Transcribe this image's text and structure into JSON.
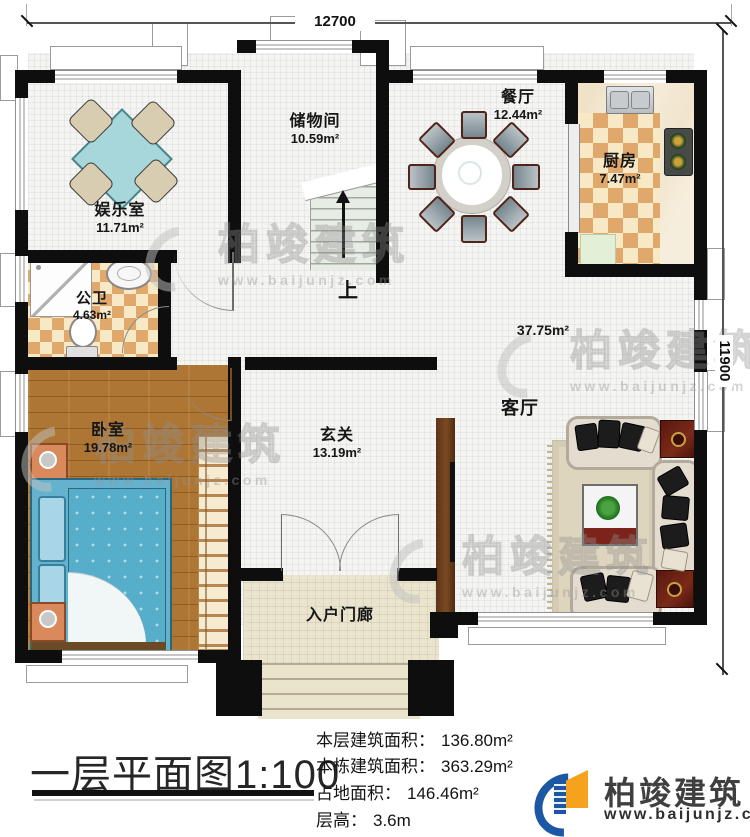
{
  "plan": {
    "title": "一层平面图1:100",
    "dim_top": "12700",
    "dim_right": "11900",
    "stairs_up": "上",
    "rooms": {
      "entertainment": {
        "name": "娱乐室",
        "area": "11.71m²"
      },
      "storage": {
        "name": "储物间",
        "area": "10.59m²"
      },
      "dining": {
        "name": "餐厅",
        "area": "12.44m²"
      },
      "kitchen": {
        "name": "厨房",
        "area": "7.47m²"
      },
      "bathroom": {
        "name": "公卫",
        "area": "4.63m²"
      },
      "bedroom": {
        "name": "卧室",
        "area": "19.78m²"
      },
      "foyer": {
        "name": "玄关",
        "area": "13.19m²"
      },
      "living": {
        "name": "客厅",
        "area": "37.75m²"
      },
      "porch": {
        "name": "入户门廊"
      }
    }
  },
  "info": {
    "floor_area": {
      "label": "本层建筑面积：",
      "value": "136.80m²"
    },
    "building_area": {
      "label": "本栋建筑面积：",
      "value": "363.29m²"
    },
    "footprint_area": {
      "label": "占地面积：",
      "value": "146.46m²"
    },
    "floor_height": {
      "label": "层高：",
      "value": "3.6m"
    }
  },
  "branding": {
    "company": "柏竣建筑",
    "website": "www.baijunjz.com"
  },
  "watermark": {
    "text": "柏竣建筑",
    "url": "www.baijunjz.com"
  },
  "colors": {
    "wall": "#0e0e0e",
    "logo_blue": "#1c57a5",
    "logo_orange": "#f6a21d",
    "checker_tan": "#e0a86b",
    "wood_floor": "#ad7634",
    "bed_blue": "#64b2cd"
  }
}
